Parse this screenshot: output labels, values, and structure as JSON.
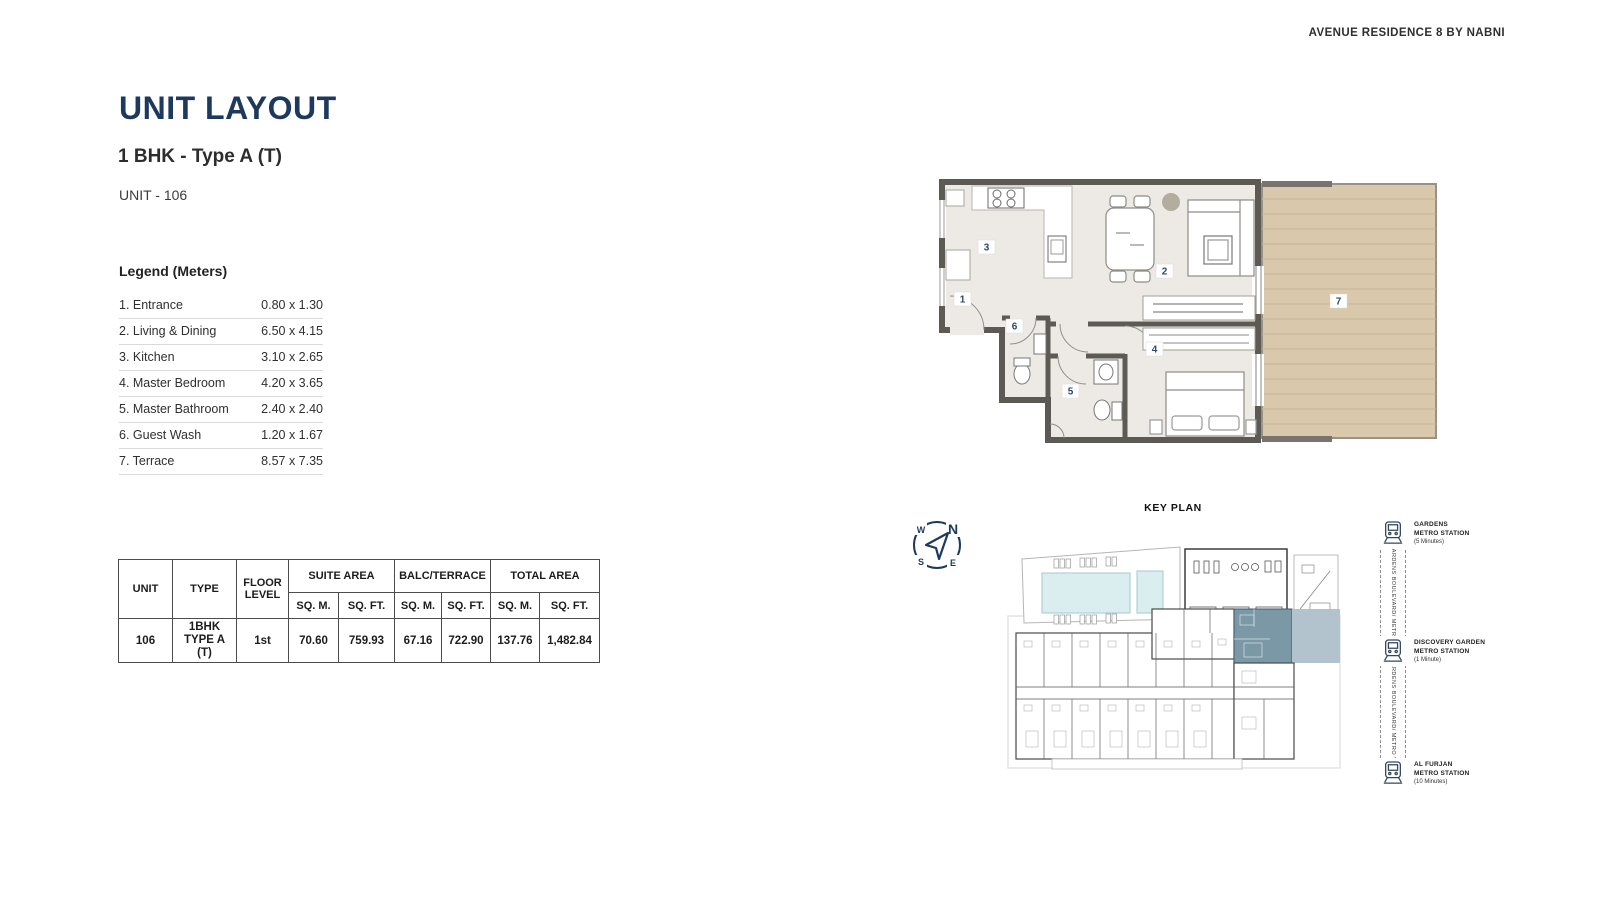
{
  "brand": "AVENUE RESIDENCE 8 BY NABNI",
  "page": {
    "title": "UNIT LAYOUT",
    "subtitle": "1 BHK - Type A (T)",
    "unit": "UNIT - 106"
  },
  "legend": {
    "title": "Legend (Meters)",
    "items": [
      {
        "name": "1. Entrance",
        "dims": "0.80 x 1.30"
      },
      {
        "name": "2. Living & Dining",
        "dims": "6.50 x 4.15"
      },
      {
        "name": "3. Kitchen",
        "dims": "3.10 x 2.65"
      },
      {
        "name": "4. Master Bedroom",
        "dims": "4.20 x 3.65"
      },
      {
        "name": "5. Master Bathroom",
        "dims": "2.40 x 2.40"
      },
      {
        "name": "6. Guest Wash",
        "dims": "1.20 x 1.67"
      },
      {
        "name": "7. Terrace",
        "dims": "8.57 x 7.35"
      }
    ]
  },
  "area_table": {
    "headers": {
      "unit": "UNIT",
      "type": "TYPE",
      "floor": "FLOOR LEVEL",
      "suite": "SUITE AREA",
      "balc": "BALC/TERRACE",
      "total": "TOTAL AREA",
      "sqm": "SQ. M.",
      "sqft": "SQ. FT."
    },
    "row": {
      "unit": "106",
      "type_line1": "1BHK",
      "type_line2": "TYPE A (T)",
      "floor": "1st",
      "suite_sqm": "70.60",
      "suite_sqft": "759.93",
      "balc_sqm": "67.16",
      "balc_sqft": "722.90",
      "total_sqm": "137.76",
      "total_sqft": "1,482.84"
    }
  },
  "floor_plan": {
    "labels": [
      "1",
      "2",
      "3",
      "4",
      "5",
      "6",
      "7"
    ]
  },
  "key_plan": {
    "title": "KEY PLAN"
  },
  "compass": {
    "n": "N",
    "e": "E",
    "s": "S",
    "w": "W"
  },
  "metro": {
    "corridor_label": "GARDENS BOULEVARD/ METRO VIEW",
    "stations": [
      {
        "line1": "GARDENS",
        "line2": "METRO STATION",
        "time": "(5 Minutes)"
      },
      {
        "line1": "DISCOVERY GARDEN",
        "line2": "METRO STATION",
        "time": "(1 Minute)"
      },
      {
        "line1": "AL FURJAN",
        "line2": "METRO STATION",
        "time": "(10 Minutes)"
      }
    ]
  },
  "colors": {
    "accent_navy": "#1d3a5e",
    "terrace_wood": "#d9c8ab",
    "highlight_unit": "#7b98a6",
    "highlight_terrace": "#b3c3cd",
    "pool": "#daeef0",
    "wall": "#5d5954"
  }
}
